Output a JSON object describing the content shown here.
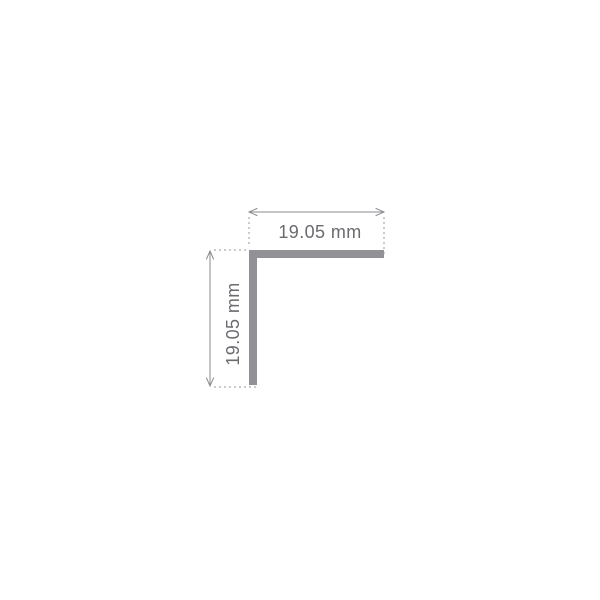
{
  "diagram": {
    "kind": "technical-dimension-drawing",
    "dimensions": {
      "width_label": "19.05 mm",
      "height_label": "19.05 mm",
      "width_value": "19.05",
      "height_value": "19.05",
      "unit": "mm"
    },
    "colors": {
      "background": "#ffffff",
      "profile": "#919196",
      "dimension_line": "#8b8b90",
      "extension_line": "#97979c",
      "label_text": "#6a6a6f"
    }
  }
}
